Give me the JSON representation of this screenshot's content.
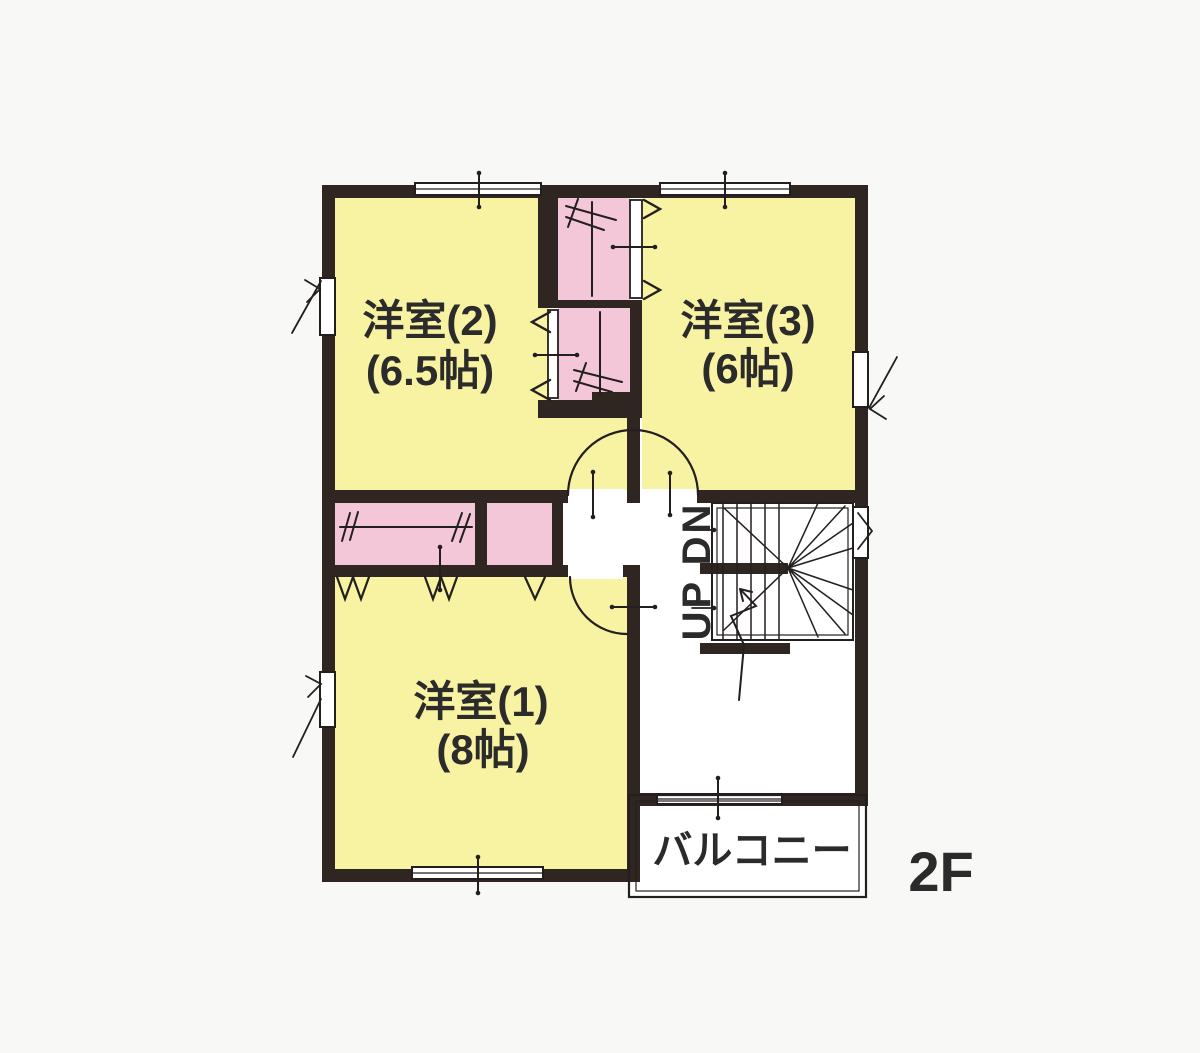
{
  "floor_plan": {
    "title": "2F floor plan",
    "labels": {
      "floor": "2F",
      "balcony": "バルコニー",
      "stairs": "UP DN",
      "room1_name": "洋室(1)",
      "room1_size": "(8帖)",
      "room2_name": "洋室(2)",
      "room2_size": "(6.5帖)",
      "room3_name": "洋室(3)",
      "room3_size": "(6帖)"
    },
    "colors": {
      "background": "#f8f8f6",
      "floor_white": "#ffffff",
      "wall": "#2f2521",
      "line": "#231f1f",
      "room_fill": "#f8f3a2",
      "closet_fill": "#f3c7d8",
      "text": "#2b2b2b"
    }
  }
}
